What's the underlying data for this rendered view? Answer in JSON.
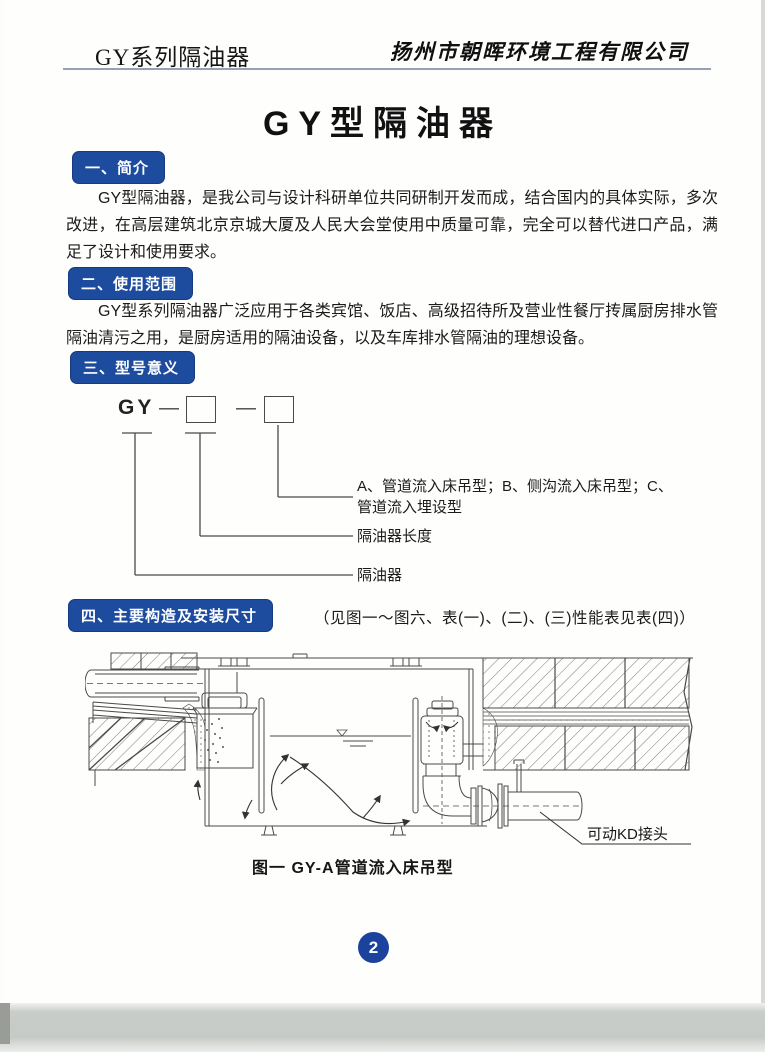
{
  "header": {
    "series": "GY系列隔油器",
    "company": "扬州市朝晖环境工程有限公司"
  },
  "title": "GY型隔油器",
  "sections": [
    {
      "badge": "一、简介",
      "text": "GY型隔油器，是我公司与设计科研单位共同研制开发而成，结合国内的具体实际，多次改进，在高层建筑北京京城大厦及人民大会堂使用中质量可靠，完全可以替代进口产品，满足了设计和使用要求。"
    },
    {
      "badge": "二、使用范围",
      "text": "GY型系列隔油器广泛应用于各类宾馆、饭店、高级招待所及营业性餐厅抟属厨房排水管隔油清污之用，是厨房适用的隔油设备，以及车库排水管隔油的理想设备。"
    },
    {
      "badge": "三、型号意义"
    },
    {
      "badge": "四、主要构造及安装尺寸",
      "note": "（见图一～图六、表(一)、(二)、(三)性能表见表(四)）"
    }
  ],
  "model_diagram": {
    "prefix": "GY",
    "dash": "—",
    "labels": {
      "type": "A、管道流入床吊型；B、侧沟流入床吊型；C、管道流入埋设型",
      "length": "隔油器长度",
      "device": "隔油器"
    }
  },
  "figure": {
    "kd_label": "可动KD接头",
    "caption": "图一 GY-A管道流入床吊型"
  },
  "footer": {
    "page_number": "2"
  },
  "colors": {
    "badge_blue": "#1d4b9e",
    "page_number_blue": "#1b429c"
  }
}
